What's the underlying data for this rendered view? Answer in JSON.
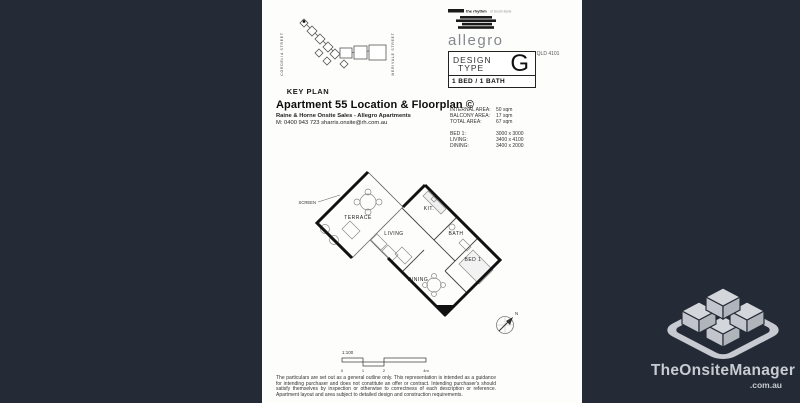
{
  "canvas": {
    "background_color": "#242b36",
    "paper_color": "#fdfdfc"
  },
  "brand": {
    "tagline_bold": "the rhythm",
    "tagline_rest": "of South Bank",
    "logo_text": "allegro",
    "address": "42 Cordelia Street, SOUTH BRISBANE QLD 4101"
  },
  "design": {
    "label_line1": "DESIGN",
    "label_line2": "TYPE",
    "letter": "G",
    "bed_bath": "1 BED / 1 BATH"
  },
  "keyplan": {
    "caption": "KEY PLAN",
    "street_left": "CORDELIA STREET",
    "street_right": "MERIVALE STREET"
  },
  "title_block": {
    "title": "Apartment 55 Location & Floorplan ©",
    "subtitle": "Raine & Horne Onsite Sales -  Allegro Apartments",
    "contact": "M: 0400 943 723 sharris.onsite@rh.com.au"
  },
  "areas": {
    "rows": [
      {
        "label": "INTERNAL AREA:",
        "value": "50 sqm"
      },
      {
        "label": "BALCONY AREA:",
        "value": "17 sqm"
      },
      {
        "label": "TOTAL AREA:",
        "value": "67 sqm"
      }
    ],
    "dims": [
      {
        "label": "BED 1:",
        "value": "3000 x 3000"
      },
      {
        "label": "LIVING:",
        "value": "3400 x 4100"
      },
      {
        "label": "DINING:",
        "value": "3400 x 2000"
      }
    ]
  },
  "plan": {
    "labels": {
      "screen": "SCREEN",
      "terrace": "TERRACE",
      "living": "LIVING",
      "kit": "KIT.",
      "bath": "BATH",
      "bed": "BED 1",
      "dining": "DINING"
    },
    "north": "N",
    "scale": {
      "ratio": "1:100",
      "ticks": [
        "0",
        "1",
        "2",
        "4m"
      ]
    }
  },
  "disclaimer": "The particulars are set out as a general outline only. This representation is intended as a guidance for intending purchaser and does not constitute an offer or contract. Intending purchaser's should satisfy themselves by inspection or otherwise to correctness of each description or reference. Apartment layout and area subject to detailed design and construction requirements.",
  "watermark": {
    "name": "TheOnsiteManager",
    "domain": ".com.au"
  }
}
